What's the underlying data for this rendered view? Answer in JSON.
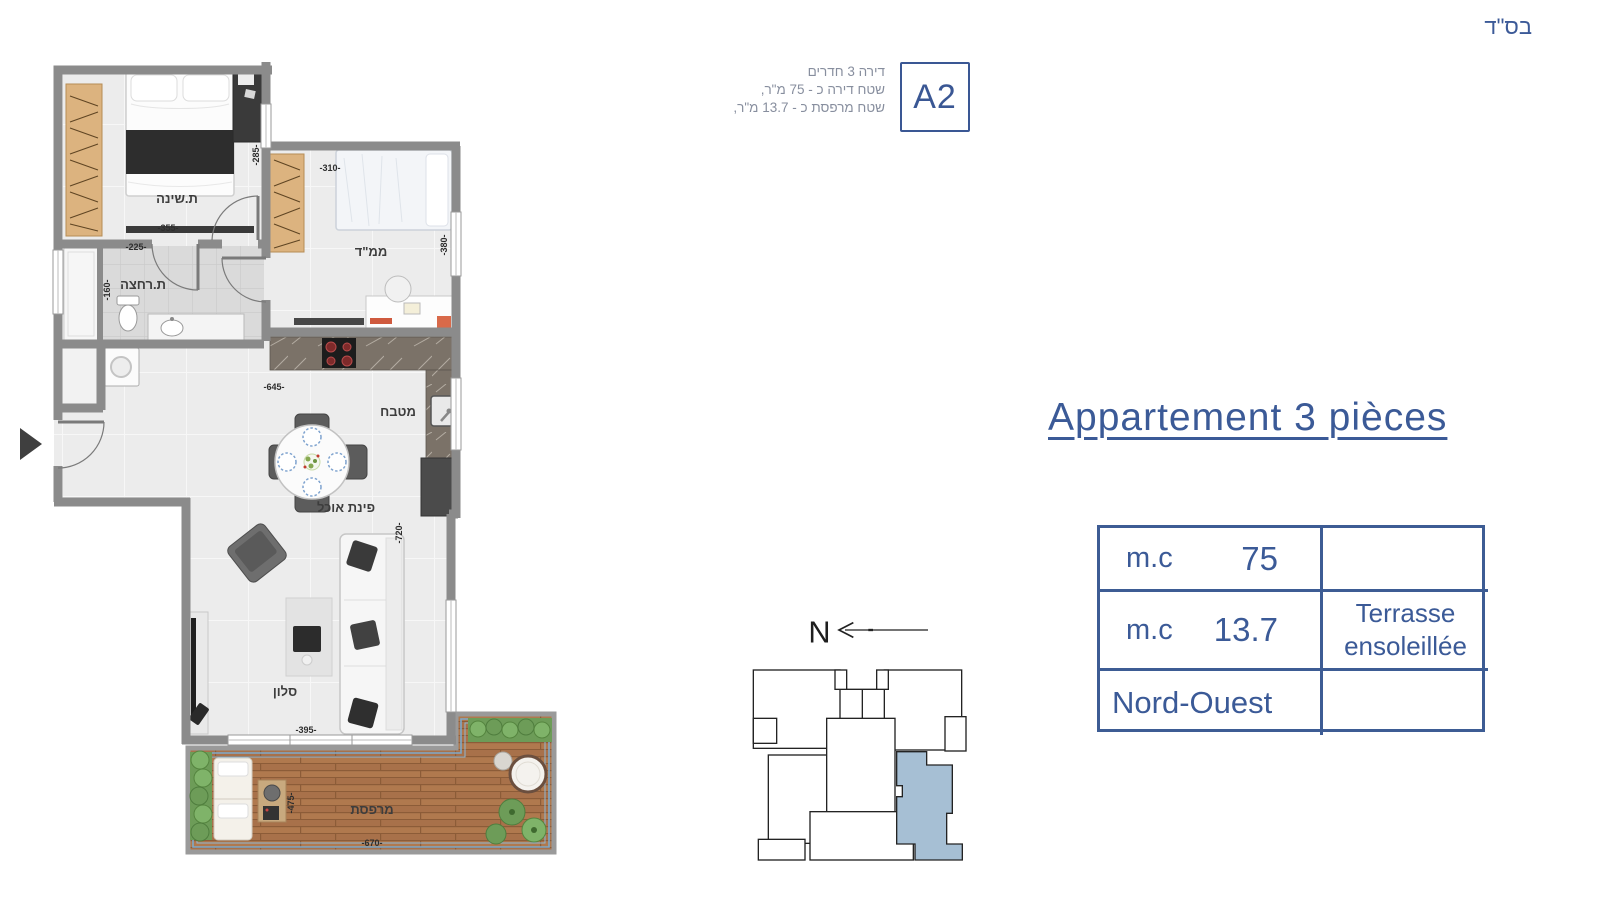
{
  "page": {
    "bsd": "בס\"ד"
  },
  "unit_card": {
    "code": "A2",
    "line1": "דירה 3 חדרים",
    "line2": "שטח דירה כ - 75 מ\"ר,",
    "line3": "שטח מרפסת כ - 13.7 מ\"ר,"
  },
  "title": {
    "text": "Appartement 3 pièces"
  },
  "spec_table": {
    "rows": [
      {
        "unit": "m.c",
        "value": "75",
        "note": ""
      },
      {
        "unit": "m.c",
        "value": "13.7",
        "note_line1": "Terrasse",
        "note_line2": "ensoleillée"
      },
      {
        "label": "Nord-Ouest",
        "note": ""
      }
    ]
  },
  "compass": {
    "label": "N"
  },
  "floor_plan": {
    "rooms": {
      "bedroom": "ת.שינה",
      "mamad": "ממ\"ד",
      "bathroom": "ת.רחצה",
      "kitchen": "מטבח",
      "dining": "פינת אוכל",
      "living": "סלון",
      "terrace": "מרפסת"
    },
    "dimensions": {
      "d355": "-355-",
      "d285": "-285-",
      "d225": "-225-",
      "d160": "-160-",
      "d310": "-310-",
      "d380": "-380-",
      "d645": "-645-",
      "d720": "-720-",
      "d395": "-395-",
      "d475": "-475-",
      "d670": "-670-"
    }
  },
  "colors": {
    "accent_blue": "#3b5a97",
    "muted_header_text": "#878e9e",
    "wall_gray": "#8b8b8b",
    "highlighted_unit_fill": "#a6bfd4",
    "deck_wood": "#b0794e"
  }
}
